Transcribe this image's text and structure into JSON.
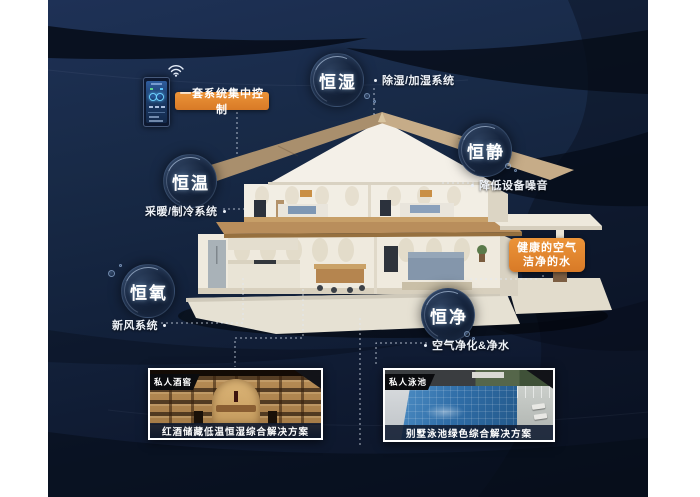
{
  "scene": {
    "colors": {
      "page_margin": "#ffffff",
      "background_navy": "#15253f",
      "swoosh_dark": "#060d18",
      "accent_orange": "#e0862f",
      "bubble_fill": "#14233a",
      "text_white": "#ffffff",
      "caption_bar": "#101c30"
    }
  },
  "control_panel": {
    "callout": "一套系统集中控制"
  },
  "water_air_callout": {
    "line1": "健康的空气",
    "line2": "洁净的水"
  },
  "features": [
    {
      "bubble": "恒湿",
      "label": "除湿/加湿系统"
    },
    {
      "bubble": "恒静",
      "label": "降低设备噪音"
    },
    {
      "bubble": "恒温",
      "label": "采暖/制冷系统"
    },
    {
      "bubble": "恒氧",
      "label": "新风系统"
    },
    {
      "bubble": "恒净",
      "label": "空气净化&净水"
    }
  ],
  "photos": [
    {
      "tag": "私人酒窖",
      "caption": "红酒储藏低温恒湿综合解决方案"
    },
    {
      "tag": "私人泳池",
      "caption": "别墅泳池绿色综合解决方案"
    }
  ]
}
